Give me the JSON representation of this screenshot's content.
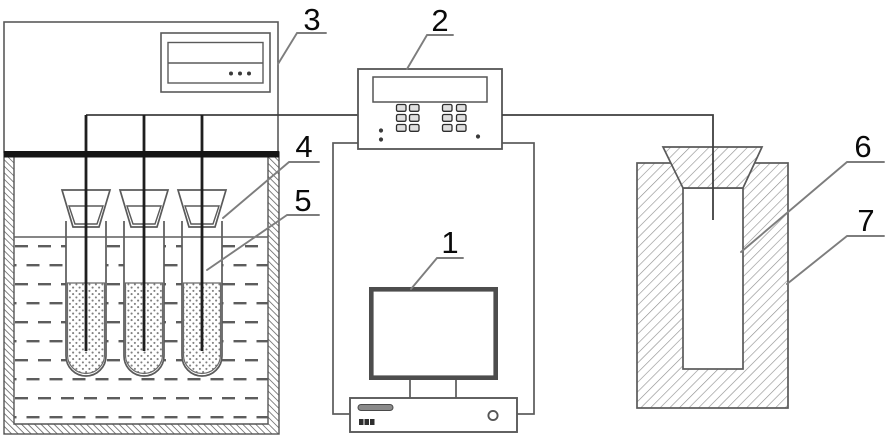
{
  "diagram": {
    "labels": [
      {
        "id": "label-1",
        "text": "1"
      },
      {
        "id": "label-2",
        "text": "2"
      },
      {
        "id": "label-3",
        "text": "3"
      },
      {
        "id": "label-4",
        "text": "4"
      },
      {
        "id": "label-5",
        "text": "5"
      },
      {
        "id": "label-6",
        "text": "6"
      },
      {
        "id": "label-7",
        "text": "7"
      }
    ],
    "colors": {
      "background": "#ffffff",
      "line": "#5a5a5a",
      "dark_line": "#1f1f1f",
      "heater_bar": "#151515",
      "leader": "#7d7d7d",
      "label_text": "#0a0a0a",
      "hatch_furnace": "#8f8f8f",
      "hatch_tank": "#6f6f6f",
      "water_dash": "#5d5d5d",
      "stipple_dot": "#808080"
    }
  }
}
